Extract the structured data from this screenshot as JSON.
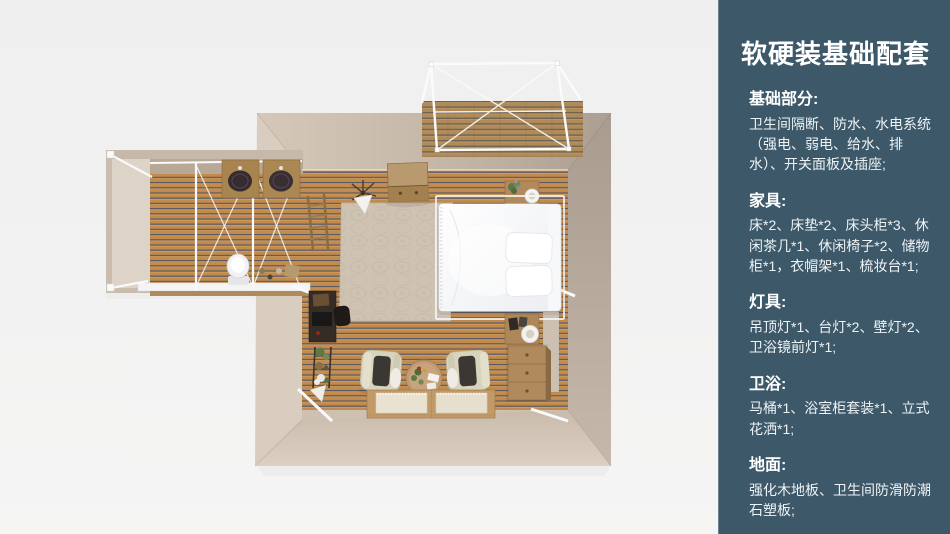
{
  "canvas": {
    "width": 950,
    "height": 534,
    "background": "#f0f0f1"
  },
  "sidebar": {
    "background": "#3c5869",
    "text_color": "#ffffff",
    "title": "软硬装基础配套",
    "sections": [
      {
        "heading": "基础部分:",
        "body": "卫生间隔断、防水、水电系统（强电、弱电、给水、排水）、开关面板及插座;"
      },
      {
        "heading": "家具:",
        "body": "床*2、床垫*2、床头柜*3、休闲茶几*1、休闲椅子*2、储物柜*1，衣帽架*1、梳妆台*1;"
      },
      {
        "heading": "灯具:",
        "body": "吊顶灯*1、台灯*2、壁灯*2、卫浴镜前灯*1;"
      },
      {
        "heading": "卫浴:",
        "body": "马桶*1、浴室柜套装*1、立式花洒*1;"
      },
      {
        "heading": "地面:",
        "body": "强化木地板、卫生间防滑防潮石塑板;"
      }
    ]
  },
  "floorplan": {
    "view": "top-down-3d-render",
    "palette": {
      "background": "#f0f0f1",
      "wall": "#cfc1b2",
      "wall_dark": "#a89b8f",
      "wall_light": "#d9cdc0",
      "wood_floor": "#c38b4b",
      "wood_gap": "#555967",
      "deck_wood": "#b08a58",
      "rug": "#cec2b3",
      "frame_white": "#fafafa",
      "bed_white": "#f7f8fa",
      "furniture_wood": "#b08a5c",
      "chair_cream": "#d8d3bd"
    },
    "items": [
      "bathroom-wing",
      "double-vanity-sinks",
      "toilet",
      "glass-partition-frames",
      "main-bedroom",
      "double-bed",
      "bed-canopy-frame",
      "area-rug",
      "nightstand-top",
      "nightstand-bottom",
      "table-lamps",
      "storage-cabinet",
      "dresser",
      "desk",
      "desk-chair",
      "plant-stand",
      "coat-rack",
      "armchair-left",
      "armchair-right",
      "coffee-table",
      "floor-bed-platform",
      "outdoor-deck",
      "deck-canopy-frame"
    ]
  }
}
